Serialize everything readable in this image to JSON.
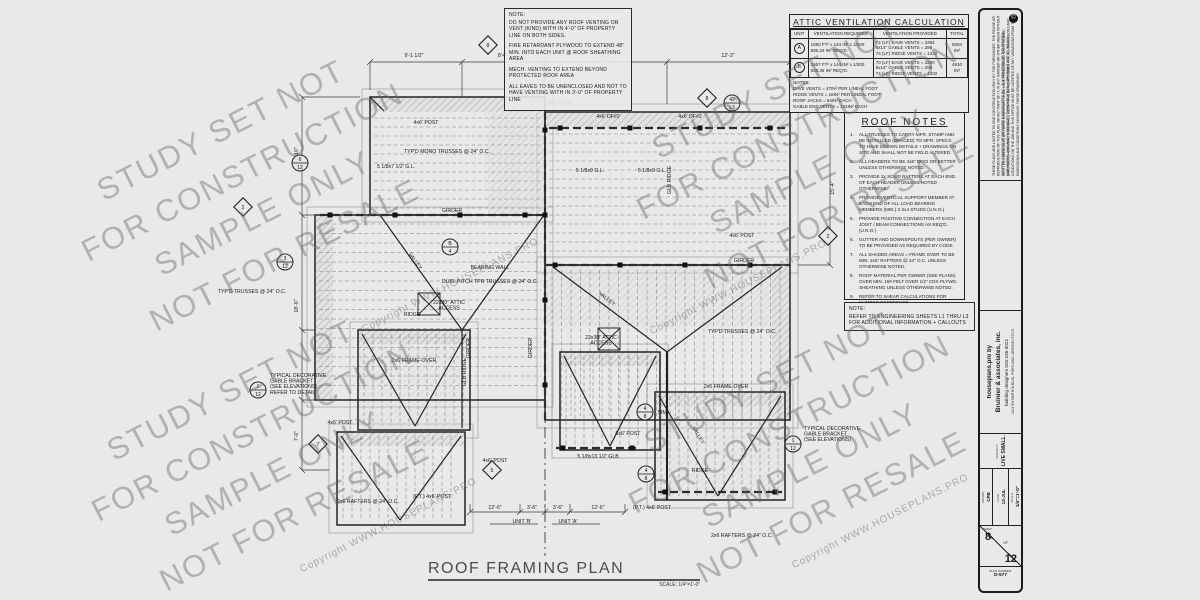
{
  "top_note": {
    "title": "NOTE:",
    "paragraphs": [
      "DO NOT PROVIDE ANY ROOF VENTING OR VENT (KIND) WITH IN 4'-0\" OF PROPERTY LINE ON BOTH SIDES.",
      "FIRE RETARDANT PLYWOOD TO EXTEND 48\" MIN. INTO EACH UNIT @ ROOF SHEATHING AREA",
      "MECH. VENTING TO EXTEND BEYOND PROTECTED ROOF AREA",
      "ALL EAVES TO BE UNENCLOSED AND NOT TO HAVE VENTING WITH IN 3'-0\" OF PROPERTY LINE"
    ]
  },
  "vent_table": {
    "title": "ATTIC VENTILATION CALCULATION",
    "headers": [
      "UNIT",
      "VENTILATION REQUIRED",
      "VENTILATION PROVIDED",
      "TOTAL"
    ],
    "rows": [
      {
        "unit": "A",
        "required": "1950 FT² x 144 IN² x 1/300\n936.24 IN²  REQ'D.",
        "provided": [
          "72 (LF) EAVE VENTS = 3384",
          "6x14\" GABLE VENTS = 288",
          "74 (LF) RIDGE VENTS = 1332"
        ],
        "total": "5004\nIN²"
      },
      {
        "unit": "B",
        "required": "1957 FT² x 144 IN² x 1/300\n939.36 IN²  REQ'D.",
        "provided": [
          "70 (LF) EAVE VENTS = 3290",
          "6x14\" GABLE VENTS = 288",
          "74 (LF) RIDGE VENTS = 1332"
        ],
        "total": "4910\nIN²"
      }
    ],
    "notes_title": "NOTES:",
    "notes": [
      "EAVE VENTS = 47IN² PER LINEAL FOOT",
      "RIDGE VENTS = 18IN² PER LINEAL FOOT",
      "ROOF JACKS = 64IN² EACH",
      "GABLE END VENTS = 144IN² EACH"
    ]
  },
  "roof_notes": {
    "title": "ROOF NOTES",
    "items": [
      "ALL TRUSSES TO CARRY MFR. STAMP AND BE INSTALLED (BRACED) TO MFR. SPECS. TO HAVE DESIGN DETAILS + DRAWINGS ON SITE AND SHALL NOT BE FIELD ALTERED.",
      "ALL HEADERS TO BE 4x6\" DF#2 OR BETTER UNLESS OTHERWISE NOTED.",
      "PROVIDE 2x SOLID RAFTERS AT EACH END OF EACH HEADER UNLESS NOTED OTHERWISE.",
      "PROVIDE VERTICAL SUPPORT MEMBER AT EACH END OF ALL LOAD BEARING MEMBERS (MIN.) 2-2x4 STUDS (U.N.O.)",
      "PROVIDE POSITIVE CONNECTION AT EACH JOIST / BEAM CONNECTIONS AS REQ'D. (U.N.O.)",
      "GUTTER AND DOWNSPOUTS (PER OWNER) TO BE PROVIDED AS REQUIRED BY CODE.",
      "ALL SHADED AREAS = FRAME OVER TO BE MIN. 2x6\" RAFTERS @ 24\" O.C. UNLESS OTHERWISE NOTED.",
      "ROOF MATERIAL PER OWNER (SEE PLANS) OVER MIN. 15# FELT OVER 1/2\" CDX PLYWD. SHEATHING UNLESS OTHERWISE NOTED.",
      "REFER TO SHEAR CALCULATIONS FOR NUMBER REFERENCE."
    ]
  },
  "eng_note": {
    "title": "NOTE:",
    "text": "REFER TO ENGINEERING SHEETS L1 THRU L3 FOR ADDITIONAL INFORMATION + CALLOUTS"
  },
  "plan_title": {
    "text": "ROOF FRAMING PLAN",
    "scale": "SCALE: 1/4\"=1'-0\""
  },
  "watermark": {
    "lines": [
      "STUDY SET NOT",
      "FOR CONSTRUCTION",
      "SAMPLE ONLY",
      "NOT FOR RESALE"
    ],
    "copyright": "Copyright WWW.HOUSEPLANS.PRO"
  },
  "titleblock": {
    "copyright1": "THESE PLANS ARE LIMITED TO ONE CONSTRUCTION ONLY BY THE PURCHASER. THE REUSE OR REPRODUCTION OF THIS PLAN, OR ANY PART OF IT, IN ANY MANNER OR OTHER MEDIA WITHOUT WRITTEN CONSENT OF BRUINIER & ASSOCIATES INC. IS A VIOLATION OF THE FEDERAL COPYRIGHT LAWS AND IS SUBJECT TO PROSECUTION. COPYRIGHT ACT 17 USC 101.",
    "copyright2": "WRITTEN DIMENSIONS ON THESE DRAWINGS SHALL HAVE PRECEDENCE OVER SCALED DIMENSIONS. CONTRACTORS SHALL VERIFY AND BE RESPONSIBLE FOR ALL DIMENSIONS AND CONDITIONS ON THE JOB AND THIS OFFICE MUST BE NOTIFIED OF ANY VARIATIONS FROM THE DIMENSIONS AND CONDITIONS SHOWN BY THESE DRAWINGS.",
    "copyright_symbol": "©",
    "brand": {
      "line1": "houseplans.pro by",
      "line2": "Bruinier & associates, inc.",
      "line3": "building designers 503-246-3022",
      "line4": "1304 SW BERTHA BLVD, PORTLAND, OREGON 97219"
    },
    "project_label": "PROJECT:",
    "project": "LIVE SMALL.",
    "fields": [
      {
        "label": "DRAWN:",
        "value": "CPB"
      },
      {
        "label": "DATE:",
        "value": "12-JUL"
      },
      {
        "label": "SCALE:",
        "value": "1/4\"=1'-0\""
      }
    ],
    "sheet_label": "SHEET",
    "sheet_no": "8",
    "of_label": "OF",
    "sheet_total": "12",
    "plan_no_label": "PLAN NUMBER:",
    "plan_no": "D-577"
  },
  "plan": {
    "labels": [
      {
        "t": "TYP'D MONO TRUSSES @ 24\" O.C.",
        "x": 447,
        "y": 153
      },
      {
        "t": "TYP'D TRUSSES @ 24\" O.C.",
        "x": 252,
        "y": 293
      },
      {
        "t": "TYP'D TRUSSES @ 24\" O.C.",
        "x": 742,
        "y": 333
      },
      {
        "t": "BEARING WALL",
        "x": 490,
        "y": 269
      },
      {
        "t": "DUEL PITCH TPR TRUSSES @ 24\" O.C.",
        "x": 490,
        "y": 283
      },
      {
        "t": "22x30\" ATTIC\nACCESS",
        "x": 449,
        "y": 304
      },
      {
        "t": "22x30\" ATTIC\nACCESS",
        "x": 601,
        "y": 339
      },
      {
        "t": "GIRDER",
        "x": 452,
        "y": 212
      },
      {
        "t": "GIRDER",
        "x": 744,
        "y": 262
      },
      {
        "t": "GIRDER",
        "x": 470,
        "y": 348,
        "r": -90
      },
      {
        "t": "GIRDER",
        "x": 532,
        "y": 348,
        "r": -90
      },
      {
        "t": "GLB RIDGE",
        "x": 671,
        "y": 180,
        "r": -90
      },
      {
        "t": "GLB RIDGE",
        "x": 466,
        "y": 372,
        "r": -90
      },
      {
        "t": "RIDGE",
        "x": 412,
        "y": 316
      },
      {
        "t": "RIDGE",
        "x": 700,
        "y": 472
      },
      {
        "t": "VALLEY",
        "x": 414,
        "y": 262,
        "r": 54
      },
      {
        "t": "VALLEY",
        "x": 606,
        "y": 300,
        "r": 37
      },
      {
        "t": "VALLEY",
        "x": 697,
        "y": 436,
        "r": 58
      },
      {
        "t": "4x6' POST",
        "x": 426,
        "y": 124
      },
      {
        "t": "4x6' POST",
        "x": 560,
        "y": 104
      },
      {
        "t": "4x6' POST",
        "x": 742,
        "y": 237
      },
      {
        "t": "4x6' POST",
        "x": 340,
        "y": 424
      },
      {
        "t": "4x6' POST",
        "x": 495,
        "y": 462
      },
      {
        "t": "6x6' POST",
        "x": 628,
        "y": 435
      },
      {
        "t": "(P.T.) 4x6' POST",
        "x": 432,
        "y": 498
      },
      {
        "t": "(P.T.) 4x6' POST",
        "x": 652,
        "y": 509
      },
      {
        "t": "4x6' DF#2",
        "x": 690,
        "y": 118
      },
      {
        "t": "4x6' DF#2",
        "x": 608,
        "y": 118
      },
      {
        "t": "5 1/8x9 G.L.",
        "x": 590,
        "y": 172
      },
      {
        "t": "5 1/8x9 G.L.",
        "x": 652,
        "y": 172
      },
      {
        "t": "5 1/8x7 1/2' G.L.",
        "x": 396,
        "y": 168
      },
      {
        "t": "5 1/8x13 1/2' GLB",
        "x": 598,
        "y": 458
      },
      {
        "t": "2x6 RAFTERS @ 24\" O.C.",
        "x": 368,
        "y": 503
      },
      {
        "t": "2x6 RAFTERS @ 24\" O.C.",
        "x": 742,
        "y": 537
      },
      {
        "t": "2x6 FRAME-OVER",
        "x": 414,
        "y": 362
      },
      {
        "t": "2x6 FRAME-OVER",
        "x": 726,
        "y": 388
      },
      {
        "t": "TYPICAL DECORATIVE\nGABLE BRACKET\n(SEE ELEVATIONS)\nREFER TO DETAIL",
        "x": 270,
        "y": 377,
        "a": "start"
      },
      {
        "t": "TYPICAL DECORATIVE\nGABLE BRACKET\n(SEE ELEVATIONS)",
        "x": 804,
        "y": 430,
        "a": "start"
      },
      {
        "t": "SIM.",
        "x": 663,
        "y": 414
      },
      {
        "t": "9'-1 1/2\"",
        "x": 414,
        "y": 57
      },
      {
        "t": "8'-0\"",
        "x": 503,
        "y": 57
      },
      {
        "t": "12'-3\"",
        "x": 605,
        "y": 57
      },
      {
        "t": "12'-3\"",
        "x": 728,
        "y": 57
      },
      {
        "t": "11'-10\"",
        "x": 298,
        "y": 155,
        "r": -90
      },
      {
        "t": "18'-6\"",
        "x": 298,
        "y": 306,
        "r": -90
      },
      {
        "t": "7'-0\"",
        "x": 298,
        "y": 436,
        "r": -90
      },
      {
        "t": "15'-4\"",
        "x": 834,
        "y": 188,
        "r": -90
      },
      {
        "t": "12'-6\"",
        "x": 495,
        "y": 509
      },
      {
        "t": "3'-6\"",
        "x": 532,
        "y": 509
      },
      {
        "t": "3'-6\"",
        "x": 558,
        "y": 509
      },
      {
        "t": "12'-6\"",
        "x": 598,
        "y": 509
      },
      {
        "t": "UNIT 'B'",
        "x": 522,
        "y": 523
      },
      {
        "t": "UNIT 'A'",
        "x": 568,
        "y": 523
      }
    ],
    "callouts": [
      {
        "x": 450,
        "y": 247,
        "top": "B",
        "bot": "4"
      },
      {
        "x": 300,
        "y": 163,
        "top": "6",
        "bot": "12"
      },
      {
        "x": 285,
        "y": 262,
        "top": "3",
        "bot": "12"
      },
      {
        "x": 645,
        "y": 412,
        "top": "4",
        "bot": "8"
      },
      {
        "x": 646,
        "y": 474,
        "top": "4",
        "bot": "8"
      },
      {
        "x": 732,
        "y": 103,
        "top": "42",
        "bot": "L3"
      },
      {
        "x": 258,
        "y": 390,
        "top": "1",
        "bot": "12"
      },
      {
        "x": 793,
        "y": 444,
        "top": "1",
        "bot": "12"
      }
    ],
    "diamonds": [
      {
        "x": 488,
        "y": 45,
        "n": "8"
      },
      {
        "x": 707,
        "y": 98,
        "n": "8"
      },
      {
        "x": 243,
        "y": 207,
        "n": "2"
      },
      {
        "x": 828,
        "y": 236,
        "n": "2"
      },
      {
        "x": 318,
        "y": 444,
        "n": "7"
      },
      {
        "x": 492,
        "y": 470,
        "n": "5"
      }
    ]
  }
}
